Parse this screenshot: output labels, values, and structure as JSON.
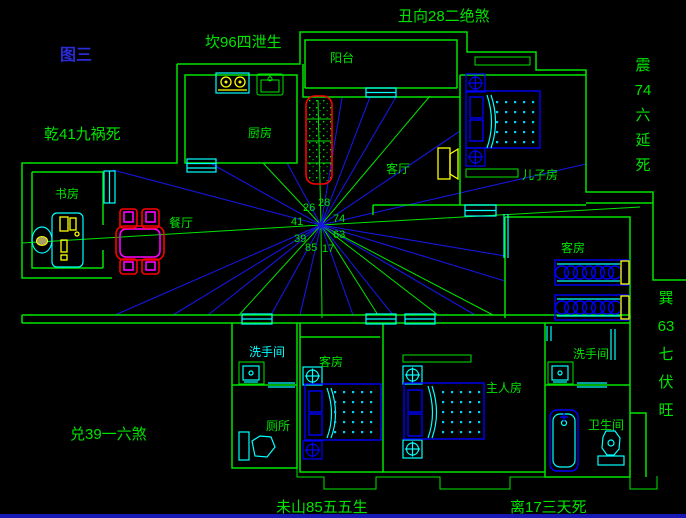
{
  "figure": {
    "label": "图三"
  },
  "annotations": {
    "top": "丑向28二绝煞",
    "top_left": "坎96四泄生",
    "west": "乾41九祸死",
    "southwest": "兑39一六煞",
    "bottom_left": "未山85五五生",
    "bottom_right": "离17三天死",
    "east_upper": [
      "震",
      "74",
      "六",
      "延",
      "死"
    ],
    "east_lower": [
      "巽",
      "63",
      "七",
      "伏",
      "旺"
    ]
  },
  "compass": {
    "26": "26",
    "28": "28",
    "74": "74",
    "41": "41",
    "63": "63",
    "39": "39",
    "85": "85",
    "17": "17"
  },
  "rooms": {
    "kitchen": "厨房",
    "balcony": "阳台",
    "living": "客厅",
    "son": "儿子房",
    "guest_east": "客房",
    "study": "书房",
    "dining": "餐厅",
    "washroom_sw": "洗手间",
    "toilet": "厕所",
    "guest_south": "客房",
    "master": "主人房",
    "washroom_se": "洗手间",
    "bathroom": "卫生间"
  },
  "colors": {
    "bg": "#000000",
    "green": "#00e400",
    "cyan": "#00ffff",
    "yellow": "#ffff00",
    "red": "#ff0000",
    "magenta": "#ff00ff",
    "fblue": "#0000ff",
    "rayblue": "#1616e0",
    "titleblue": "#2b2bd8",
    "border_blue": "#1818b4"
  }
}
